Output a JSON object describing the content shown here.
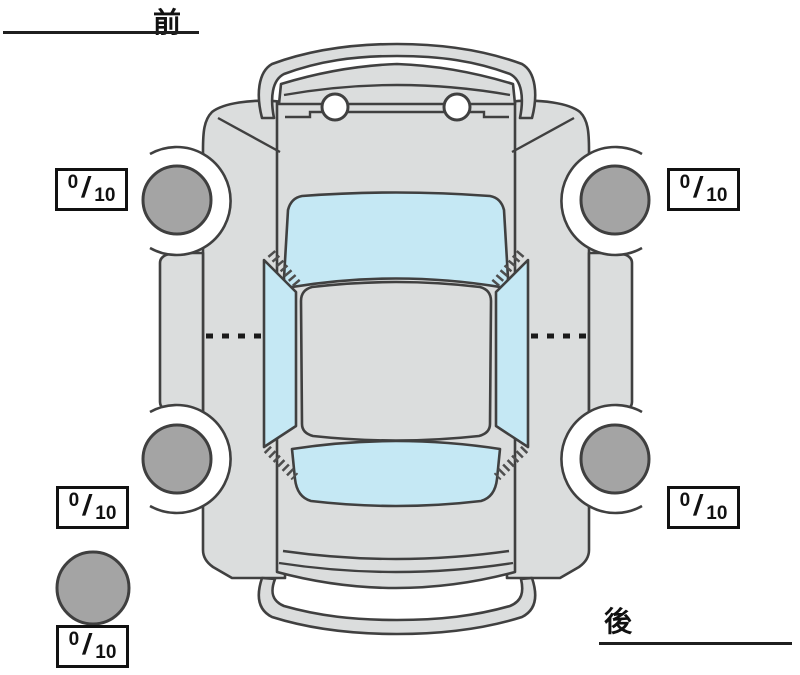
{
  "diagram": {
    "type": "vehicle-top-view-tire-inspection",
    "front_label": "前",
    "rear_label": "後",
    "colors": {
      "background": "#ffffff",
      "body": "#dbdddd",
      "outline": "#404040",
      "glass": "#c5e8f4",
      "tire": "#a4a4a4",
      "score_box_border": "#111111",
      "score_text": "#111111"
    }
  },
  "tread_scores": {
    "separator": "/",
    "front_left": {
      "value": "0",
      "max": "10"
    },
    "front_right": {
      "value": "0",
      "max": "10"
    },
    "rear_left": {
      "value": "0",
      "max": "10"
    },
    "rear_right": {
      "value": "0",
      "max": "10"
    },
    "spare": {
      "value": "0",
      "max": "10"
    }
  }
}
